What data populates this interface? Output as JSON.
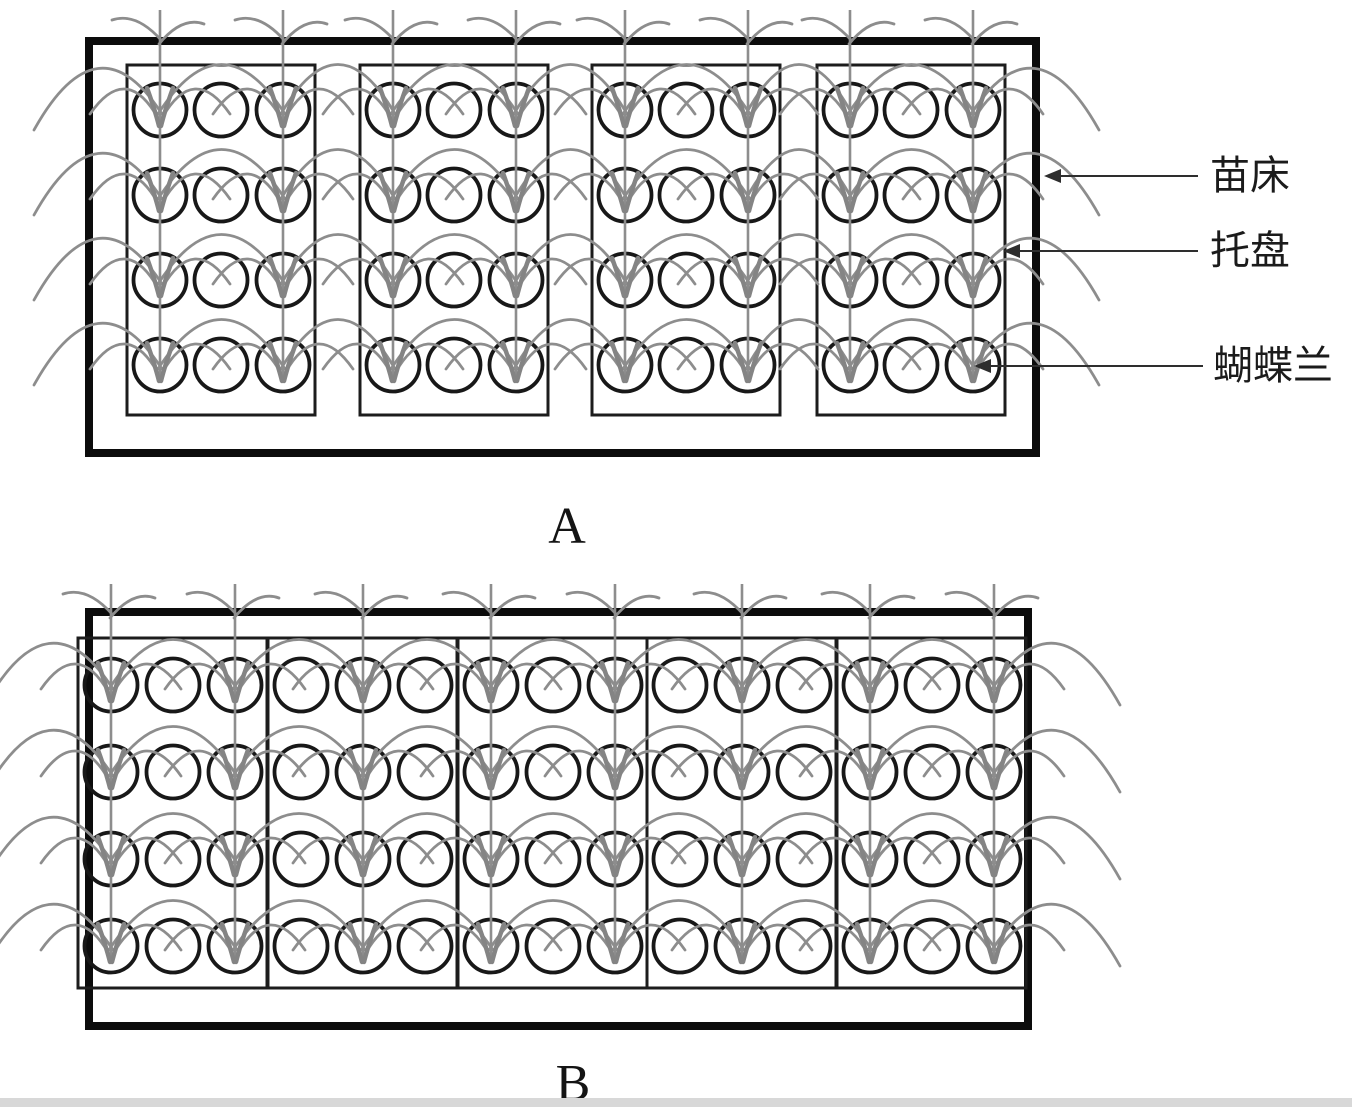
{
  "colors": {
    "background": "#ffffff",
    "bed_border": "#0c0c0c",
    "tray_border": "#1c1c1c",
    "pot_border": "#181818",
    "plant": "#8d8d8d",
    "plant_dense": "#848484",
    "annotation_line": "#2e2e2e",
    "annotation_text": "#1b1b1b",
    "caption_text": "#141414",
    "bottom_strip": "#d8d8d8"
  },
  "panels": [
    {
      "id": "a",
      "bed": {
        "left": 85,
        "top": 37,
        "right": 1040,
        "bottom": 457,
        "stroke": 8
      },
      "trays": {
        "xs": [
          127,
          360,
          592,
          817
        ],
        "width": 188,
        "top": 65,
        "height": 350,
        "stroke": 3
      },
      "pots": {
        "col_offsets": [
          33,
          94,
          156
        ],
        "row_ys": [
          110,
          195,
          280,
          365
        ],
        "radius": 26.5,
        "stroke": 3.8
      },
      "plant_cols": [
        [
          0,
          2
        ],
        [
          0,
          2
        ],
        [
          0,
          2
        ],
        [
          0,
          2
        ]
      ],
      "stem_top": 10,
      "tray_count": 4,
      "pots_per_tray": {
        "cols": 3,
        "rows": 4
      }
    },
    {
      "id": "b",
      "bed": {
        "left": 85,
        "top": 608,
        "right": 1032,
        "bottom": 1030,
        "stroke": 8
      },
      "trays": {
        "xs": [
          78,
          268,
          458,
          647,
          837
        ],
        "width": 189,
        "top": 638,
        "height": 350,
        "stroke": 3
      },
      "pots": {
        "col_offsets": [
          33,
          95,
          157
        ],
        "row_ys": [
          685,
          772,
          859,
          946
        ],
        "radius": 26.5,
        "stroke": 3.8
      },
      "plant_cols": [
        [
          0,
          2
        ],
        [
          1
        ],
        [
          0,
          2
        ],
        [
          1
        ],
        [
          0,
          2
        ]
      ],
      "stem_top": 584,
      "tray_count": 5,
      "pots_per_tray": {
        "cols": 3,
        "rows": 4
      }
    }
  ],
  "annotations": {
    "items": [
      {
        "label": "苗床",
        "line_y": 176,
        "tip_x": 1044,
        "line_end_x": 1198,
        "text_x": 1210
      },
      {
        "label": "托盘",
        "line_y": 251,
        "tip_x": 1003,
        "line_end_x": 1198,
        "text_x": 1210
      },
      {
        "label": "蝴蝶兰",
        "line_y": 366,
        "tip_x": 974,
        "line_end_x": 1203,
        "text_x": 1213
      }
    ],
    "arrowhead": {
      "length": 17,
      "half_width": 7
    }
  },
  "captions": {
    "a": {
      "text": "A",
      "x": 567,
      "y": 543
    },
    "b": {
      "text": "B",
      "x": 573,
      "y": 1100
    }
  },
  "bottom_strip": {
    "x": 0,
    "y": 1098,
    "w": 1352,
    "h": 9
  }
}
